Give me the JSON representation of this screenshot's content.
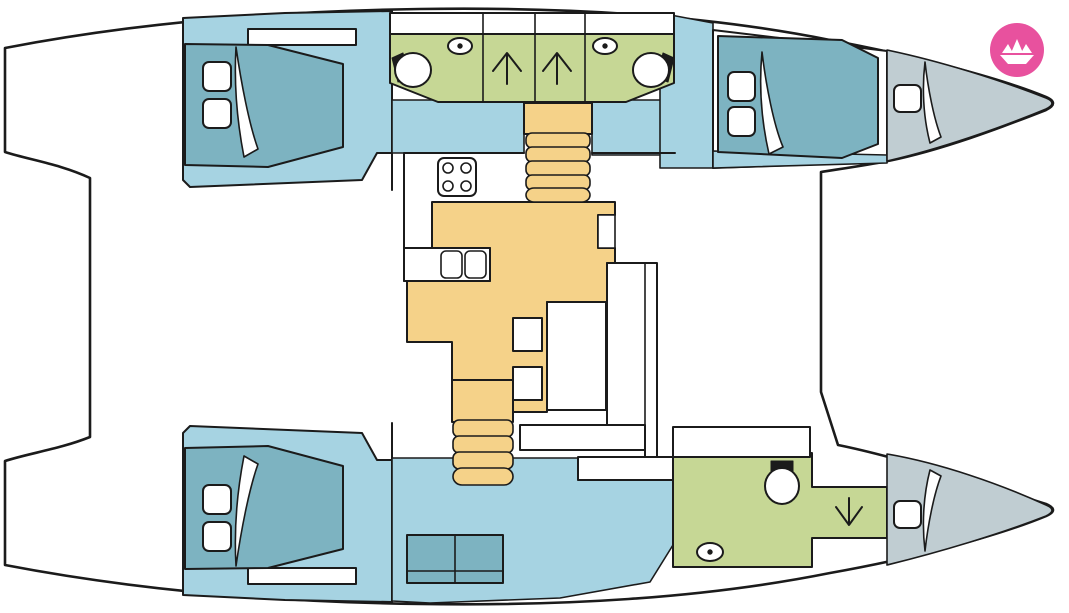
{
  "page": {
    "title": "Catamaran deck layout plan",
    "width_px": 1069,
    "height_px": 613,
    "diagram_type": "boat floor plan, top view, bow pointing right"
  },
  "branding": {
    "logo": "paper-boat-logo",
    "logo_bg": "#e8519e",
    "logo_glyph": "#ffffff"
  },
  "palette": {
    "outline": "#1b1b1b",
    "white": "#ffffff",
    "hull_floor": "#a6d3e2",
    "bed": "#7db3c1",
    "bathroom": "#c6d795",
    "galley": "#f5d289",
    "bow_berth": "#c0cdd2"
  },
  "vessel": {
    "style": "sailing catamaran, two hulls with central saloon",
    "rooms": [
      {
        "id": "starboard-aft-cabin",
        "label": "Starboard aft double cabin",
        "floor": "hull_floor",
        "features": [
          "double bed",
          "2 pillows",
          "shelf"
        ]
      },
      {
        "id": "starboard-bathroom",
        "label": "Starboard bathroom block with two shower stalls",
        "floor": "bathroom",
        "features": [
          "2 toilets",
          "2 washbasins",
          "2 showers",
          "4 deck hatches"
        ]
      },
      {
        "id": "starboard-forward-cabin",
        "label": "Starboard forward double cabin",
        "floor": "hull_floor",
        "features": [
          "double bed",
          "2 pillows"
        ]
      },
      {
        "id": "starboard-bow-berth",
        "label": "Starboard bow single berth",
        "floor": "bow_berth",
        "features": [
          "single bed",
          "1 pillow"
        ]
      },
      {
        "id": "saloon-galley",
        "label": "Central saloon and galley",
        "floor": "galley",
        "features": [
          "stove",
          "double sink",
          "fridge",
          "dinette table",
          "sofa",
          "2 seats",
          "2 companionway stairs"
        ]
      },
      {
        "id": "port-aft-cabin",
        "label": "Port aft double cabin",
        "floor": "hull_floor",
        "features": [
          "double bed",
          "2 pillows",
          "shelf"
        ]
      },
      {
        "id": "port-corridor",
        "label": "Port hull corridor",
        "floor": "hull_floor",
        "features": [
          "settee"
        ]
      },
      {
        "id": "port-bathroom",
        "label": "Port bathroom",
        "floor": "bathroom",
        "features": [
          "toilet",
          "washbasin",
          "shower"
        ]
      },
      {
        "id": "port-bow-berth",
        "label": "Port bow single berth",
        "floor": "bow_berth",
        "features": [
          "single bed",
          "1 pillow"
        ]
      }
    ],
    "icons": {
      "toilet": "circle bowl with black lid block",
      "washbasin": "oval with center dot",
      "shower": "arrow glyph",
      "stove": "rounded square with 4 burner circles",
      "galley_sink": "two rounded squares",
      "stairs": "stacked rounded treads"
    },
    "counts": {
      "double_cabins": 3,
      "single_berths": 2,
      "bathrooms": 2,
      "shower_stalls": 3,
      "toilets": 3,
      "washbasins": 3,
      "staircases": 2,
      "deck_hatches": 4
    }
  }
}
